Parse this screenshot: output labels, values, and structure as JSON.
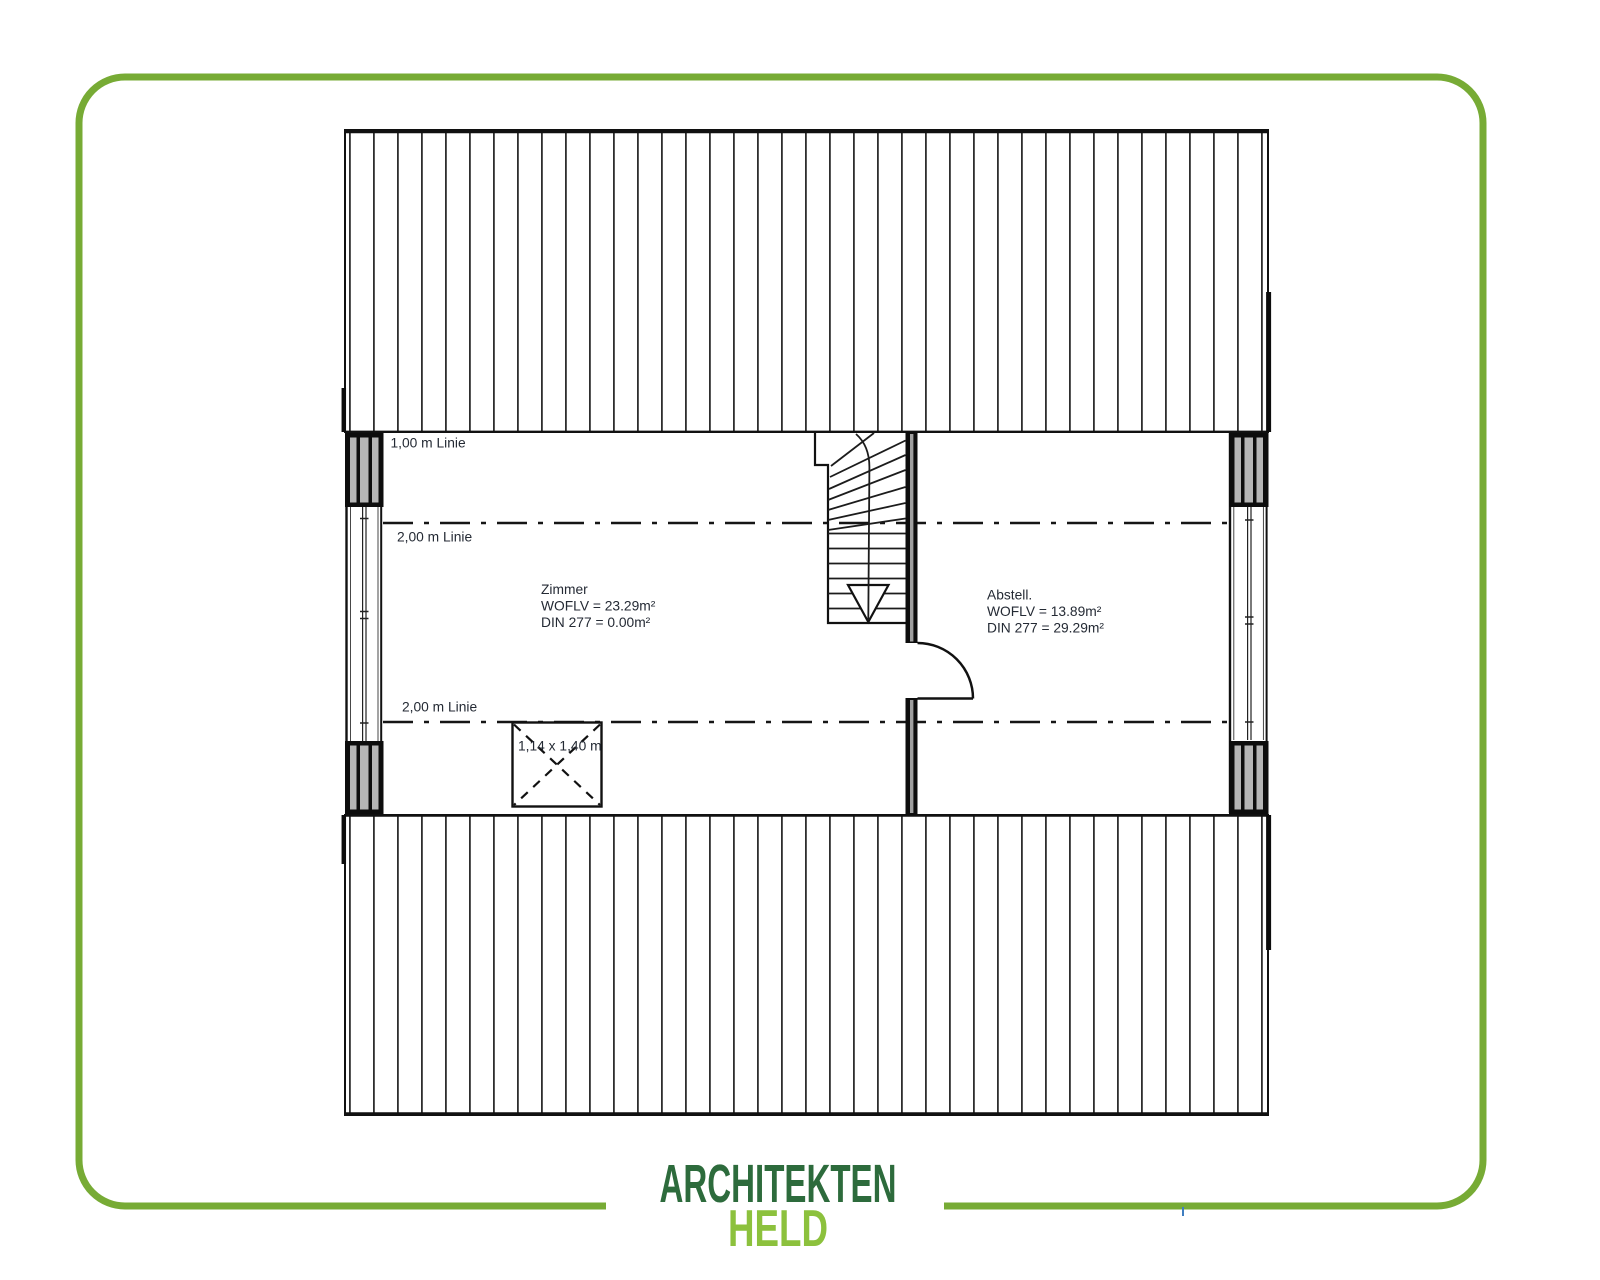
{
  "canvas": {
    "width": 1600,
    "height": 1280,
    "background": "#ffffff"
  },
  "frame": {
    "border_color": "#77ab35",
    "tick_color": "#3f7ec0"
  },
  "plan": {
    "guide_labels": {
      "top": "1,00 m Linie",
      "upper": "2,00 m Linie",
      "lower": "2,00 m Linie"
    },
    "skylight_label": "1,14 x 1,40 m",
    "rooms": [
      {
        "name": "Zimmer",
        "line2": "WOFLV = 23.29m²",
        "line3": "DIN 277 = 0.00m²"
      },
      {
        "name": "Abstell.",
        "line2": "WOFLV = 13.89m²",
        "line3": "DIN 277 = 29.29m²"
      }
    ]
  },
  "logo": {
    "line1": "ARCHITEKTEN",
    "line2": "HELD",
    "color_line1": "#2d6b3c",
    "color_line2": "#8cc13d"
  }
}
